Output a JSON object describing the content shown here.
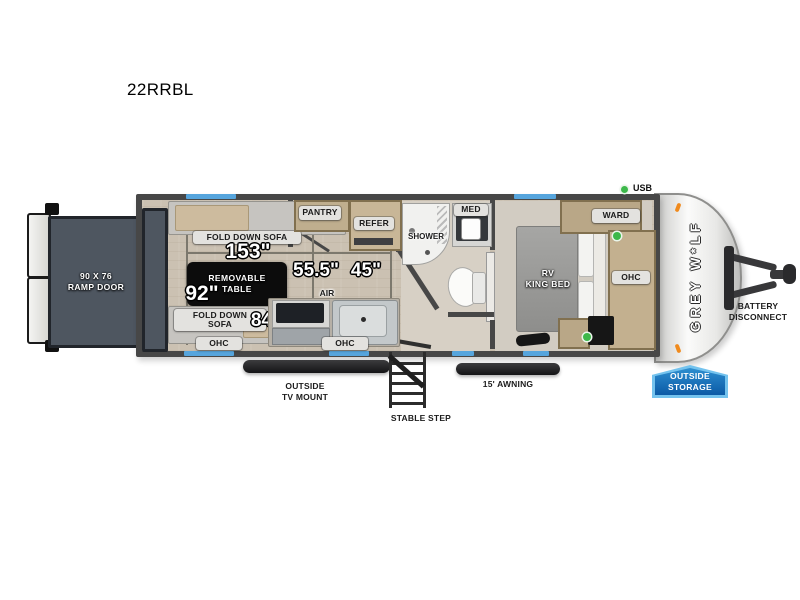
{
  "title": "22RRBL",
  "colors": {
    "window_blue": "#56a5dd",
    "badge_blue": "#0b5aa6",
    "usb_green": "#3db84a",
    "marker_orange": "#f08a1d",
    "wall_gray": "#474747",
    "floor_tan": "#cbc1b2"
  },
  "plan": {
    "ramp": {
      "size": "90 X 76",
      "name": "RAMP DOOR"
    },
    "garage": {
      "sofa_top": "FOLD DOWN SOFA",
      "sofa_bottom_l1": "FOLD DOWN",
      "sofa_bottom_l2": "SOFA",
      "table_l1": "REMOVABLE",
      "table_l2": "TABLE",
      "dim_length": "153\"",
      "dim_width": "92\"",
      "dim_sofa": "84\"",
      "ohc": "OHC"
    },
    "kitchen": {
      "pantry": "PANTRY",
      "refer": "REFER",
      "air_l1": "AIR",
      "air_l2": "FRYER",
      "dim_a": "55.5\"",
      "dim_b": "45\"",
      "ohc": "OHC"
    },
    "bath": {
      "shower": "SHOWER",
      "med": "MED"
    },
    "bedroom": {
      "bed_l1": "RV",
      "bed_l2": "KING BED",
      "ward": "WARD",
      "ohc": "OHC"
    },
    "usb": "USB",
    "logo": "GREY W*LF",
    "battery_l1": "BATTERY",
    "battery_l2": "DISCONNECT",
    "exterior": {
      "storage_l1": "OUTSIDE",
      "storage_l2": "STORAGE",
      "tv_l1": "OUTSIDE",
      "tv_l2": "TV MOUNT",
      "step": "STABLE STEP",
      "awning": "15' AWNING"
    }
  }
}
